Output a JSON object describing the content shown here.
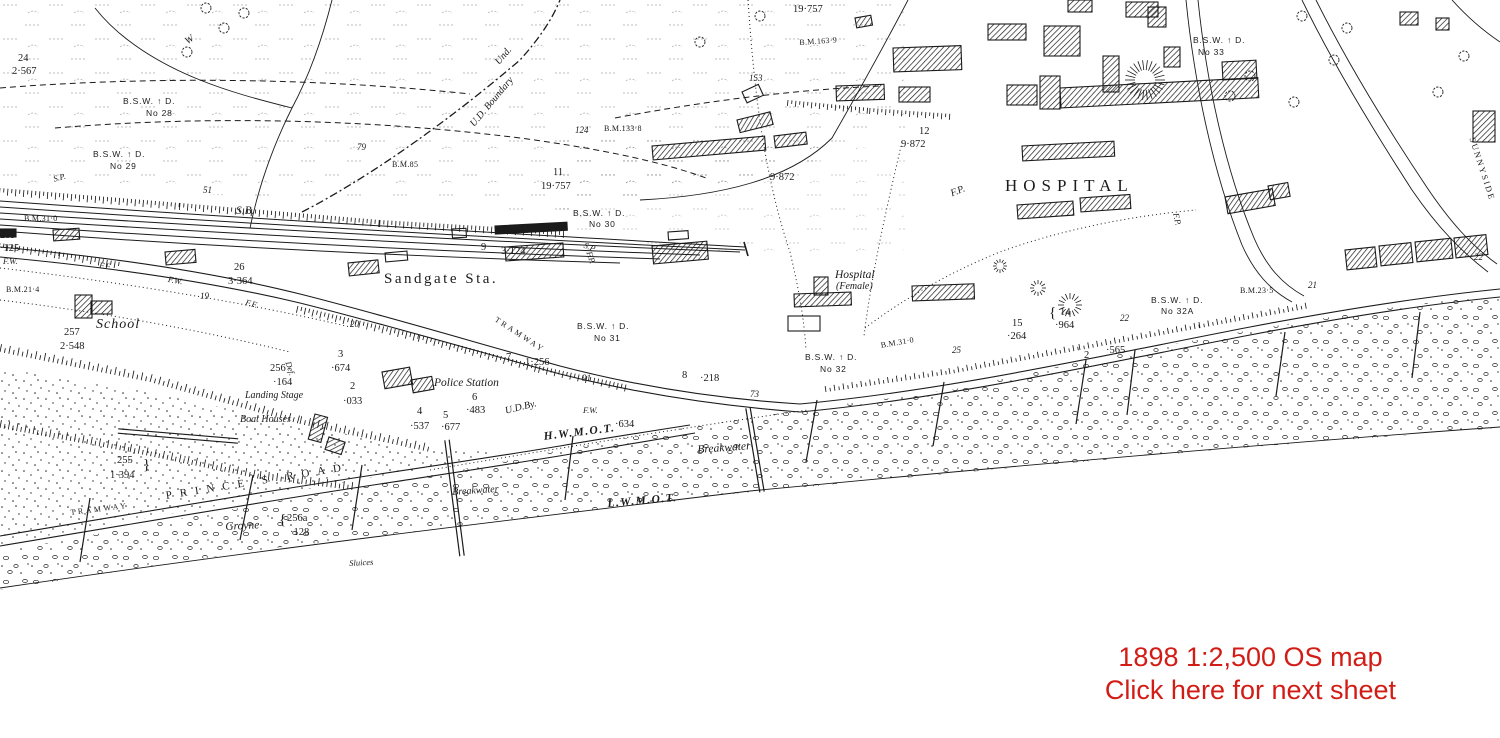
{
  "page": {
    "background": "#ffffff",
    "ink": "#1b1b1b"
  },
  "caption": {
    "line1": "1898 1:2,500 OS map",
    "line2": "Click here for next sheet",
    "color": "#d21c16"
  },
  "map": {
    "labels": [
      {
        "t": "19·757",
        "x": 793,
        "y": 4,
        "s": "n"
      },
      {
        "t": "B.M.163·9",
        "x": 799,
        "y": 38,
        "s": "bm",
        "r": -4
      },
      {
        "t": "153",
        "x": 749,
        "y": 73,
        "s": "it9"
      },
      {
        "t": "124",
        "x": 575,
        "y": 125,
        "s": "it9"
      },
      {
        "t": "B.M.133·8",
        "x": 604,
        "y": 124,
        "s": "bm"
      },
      {
        "t": "11",
        "x": 553,
        "y": 167,
        "s": "n"
      },
      {
        "t": "19·757",
        "x": 541,
        "y": 181,
        "s": "n"
      },
      {
        "t": "B.S.W. ↑ D.",
        "x": 573,
        "y": 208,
        "s": "bsw"
      },
      {
        "t": "No 30",
        "x": 589,
        "y": 219,
        "s": "bsw"
      },
      {
        "t": "Und.",
        "x": 493,
        "y": 60,
        "s": "i",
        "r": -50
      },
      {
        "t": "U.D. Boundary",
        "x": 468,
        "y": 122,
        "s": "i",
        "r": -50
      },
      {
        "t": "24",
        "x": 18,
        "y": 53,
        "s": "n"
      },
      {
        "t": "2·567",
        "x": 12,
        "y": 66,
        "s": "n"
      },
      {
        "t": "B.S.W. ↑ D.",
        "x": 123,
        "y": 96,
        "s": "bsw"
      },
      {
        "t": "No 28",
        "x": 146,
        "y": 108,
        "s": "bsw"
      },
      {
        "t": "B.S.W. ↑ D.",
        "x": 93,
        "y": 149,
        "s": "bsw"
      },
      {
        "t": "No 29",
        "x": 110,
        "y": 161,
        "s": "bsw"
      },
      {
        "t": "W",
        "x": 183,
        "y": 38,
        "s": "i",
        "r": -35
      },
      {
        "t": "79",
        "x": 357,
        "y": 142,
        "s": "it9"
      },
      {
        "t": "B.M.85",
        "x": 392,
        "y": 160,
        "s": "bm"
      },
      {
        "t": "51",
        "x": 203,
        "y": 185,
        "s": "it9"
      },
      {
        "t": "S.P.",
        "x": 52,
        "y": 174,
        "s": "i8",
        "r": -15
      },
      {
        "t": "S.B.",
        "x": 236,
        "y": 205,
        "s": "i11"
      },
      {
        "t": "B.M.31·0",
        "x": 24,
        "y": 214,
        "s": "bm"
      },
      {
        "t": "259",
        "x": 0,
        "y": 230,
        "s": "n"
      },
      {
        "t": "·125",
        "x": 0,
        "y": 243,
        "s": "n"
      },
      {
        "t": "F.W.",
        "x": 3,
        "y": 256,
        "s": "i8"
      },
      {
        "t": "B.M.21·4",
        "x": 6,
        "y": 285,
        "s": "bm"
      },
      {
        "t": "F.F.",
        "x": 100,
        "y": 260,
        "s": "i8",
        "r": 8
      },
      {
        "t": "F.W.",
        "x": 169,
        "y": 274,
        "s": "i8",
        "r": 10
      },
      {
        "t": "F.F.",
        "x": 247,
        "y": 297,
        "s": "i8",
        "r": 15
      },
      {
        "t": "26",
        "x": 234,
        "y": 262,
        "s": "n"
      },
      {
        "t": "3·364",
        "x": 228,
        "y": 276,
        "s": "n"
      },
      {
        "t": "19",
        "x": 200,
        "y": 291,
        "s": "it9"
      },
      {
        "t": "257",
        "x": 64,
        "y": 327,
        "s": "n"
      },
      {
        "t": "School",
        "x": 96,
        "y": 317,
        "s": "sch"
      },
      {
        "t": "2·548",
        "x": 60,
        "y": 341,
        "s": "n"
      },
      {
        "t": "9",
        "x": 481,
        "y": 242,
        "s": "n"
      },
      {
        "t": "3·124",
        "x": 501,
        "y": 246,
        "s": "n"
      },
      {
        "t": "Sandgate Sta.",
        "x": 384,
        "y": 271,
        "s": "sta"
      },
      {
        "t": "S.P.",
        "x": 586,
        "y": 240,
        "s": "i8",
        "r": 20
      },
      {
        "t": "B.S.W. ↑ D.",
        "x": 577,
        "y": 321,
        "s": "bsw"
      },
      {
        "t": "No 31",
        "x": 594,
        "y": 333,
        "s": "bsw"
      },
      {
        "t": "TRAMWAY",
        "x": 498,
        "y": 315,
        "s": "tw",
        "r": 33
      },
      {
        "t": "20",
        "x": 350,
        "y": 319,
        "s": "it9"
      },
      {
        "t": "7",
        "x": 506,
        "y": 352,
        "s": "n"
      },
      {
        "t": "1·256",
        "x": 525,
        "y": 357,
        "s": "n"
      },
      {
        "t": "91",
        "x": 582,
        "y": 373,
        "s": "it9"
      },
      {
        "t": "8",
        "x": 682,
        "y": 370,
        "s": "n"
      },
      {
        "t": "·218",
        "x": 700,
        "y": 373,
        "s": "n"
      },
      {
        "t": "73",
        "x": 750,
        "y": 389,
        "s": "it9"
      },
      {
        "t": "3",
        "x": 338,
        "y": 349,
        "s": "n"
      },
      {
        "t": "·674",
        "x": 331,
        "y": 363,
        "s": "n"
      },
      {
        "t": "256",
        "x": 270,
        "y": 363,
        "s": "n"
      },
      {
        "t": "·164",
        "x": 273,
        "y": 377,
        "s": "n"
      },
      {
        "t": "Def.",
        "x": 293,
        "y": 360,
        "s": "i8",
        "r": 72
      },
      {
        "t": "Landing Stage",
        "x": 245,
        "y": 390,
        "s": "i"
      },
      {
        "t": "Boat Houses",
        "x": 240,
        "y": 414,
        "s": "i"
      },
      {
        "t": "2",
        "x": 350,
        "y": 381,
        "s": "n"
      },
      {
        "t": "·033",
        "x": 343,
        "y": 396,
        "s": "n"
      },
      {
        "t": "Police Station",
        "x": 434,
        "y": 377,
        "s": "i11"
      },
      {
        "t": "6",
        "x": 472,
        "y": 392,
        "s": "n"
      },
      {
        "t": "·483",
        "x": 466,
        "y": 405,
        "s": "n"
      },
      {
        "t": "4",
        "x": 417,
        "y": 406,
        "s": "n"
      },
      {
        "t": "·537",
        "x": 410,
        "y": 421,
        "s": "n"
      },
      {
        "t": "5",
        "x": 443,
        "y": 410,
        "s": "n"
      },
      {
        "t": "·677",
        "x": 441,
        "y": 422,
        "s": "n"
      },
      {
        "t": "U.D.By.",
        "x": 504,
        "y": 406,
        "s": "i",
        "r": -14
      },
      {
        "t": "F.W.",
        "x": 583,
        "y": 405,
        "s": "i8"
      },
      {
        "t": "·634",
        "x": 615,
        "y": 419,
        "s": "n"
      },
      {
        "t": "H.W.M.O.T.",
        "x": 543,
        "y": 431,
        "s": "wm",
        "r": -7
      },
      {
        "t": "Breakwater",
        "x": 697,
        "y": 444,
        "s": "i11",
        "r": -4
      },
      {
        "t": "Breakwater",
        "x": 452,
        "y": 487,
        "s": "i",
        "r": -4
      },
      {
        "t": "L.W.M.O.T.",
        "x": 607,
        "y": 498,
        "s": "wm",
        "r": -5
      },
      {
        "t": "Hospital",
        "x": 835,
        "y": 269,
        "s": "i11"
      },
      {
        "t": "(Female)",
        "x": 836,
        "y": 281,
        "s": "i"
      },
      {
        "t": "B.M.31·0",
        "x": 880,
        "y": 341,
        "s": "bm",
        "r": -10
      },
      {
        "t": "25",
        "x": 952,
        "y": 345,
        "s": "it9"
      },
      {
        "t": "B.S.W. ↑ D.",
        "x": 805,
        "y": 352,
        "s": "bsw"
      },
      {
        "t": "No 32",
        "x": 820,
        "y": 364,
        "s": "bsw"
      },
      {
        "t": "15",
        "x": 1012,
        "y": 318,
        "s": "n"
      },
      {
        "t": "·264",
        "x": 1007,
        "y": 331,
        "s": "n"
      },
      {
        "t": "{",
        "x": 1049,
        "y": 305,
        "s": "brace"
      },
      {
        "t": "14",
        "x": 1060,
        "y": 307,
        "s": "n"
      },
      {
        "t": "·964",
        "x": 1055,
        "y": 320,
        "s": "n"
      },
      {
        "t": "22",
        "x": 1120,
        "y": 313,
        "s": "it9"
      },
      {
        "t": "B.S.W. ↑ D.",
        "x": 1151,
        "y": 295,
        "s": "bsw"
      },
      {
        "t": "No 32A",
        "x": 1161,
        "y": 306,
        "s": "bsw"
      },
      {
        "t": "B.M.23·5",
        "x": 1240,
        "y": 286,
        "s": "bm"
      },
      {
        "t": "21",
        "x": 1308,
        "y": 280,
        "s": "it9"
      },
      {
        "t": "2",
        "x": 1084,
        "y": 350,
        "s": "n"
      },
      {
        "t": "·565",
        "x": 1106,
        "y": 345,
        "s": "n"
      },
      {
        "t": "12",
        "x": 919,
        "y": 126,
        "s": "n"
      },
      {
        "t": "9·872",
        "x": 901,
        "y": 139,
        "s": "n"
      },
      {
        "t": "9·872",
        "x": 770,
        "y": 172,
        "s": "n"
      },
      {
        "t": "HOSPITAL",
        "x": 1005,
        "y": 176,
        "s": "hos"
      },
      {
        "t": "F.P.",
        "x": 949,
        "y": 189,
        "s": "i",
        "r": -22
      },
      {
        "t": "F.P.",
        "x": 594,
        "y": 250,
        "s": "i8",
        "r": 72
      },
      {
        "t": "F.P.",
        "x": 1181,
        "y": 212,
        "s": "i8",
        "r": 78
      },
      {
        "t": "B.S.W. ↑ D.",
        "x": 1193,
        "y": 35,
        "s": "bsw"
      },
      {
        "t": "No 33",
        "x": 1198,
        "y": 47,
        "s": "bsw"
      },
      {
        "t": "SUNNYSIDE",
        "x": 1477,
        "y": 136,
        "s": "sun",
        "r": 72
      },
      {
        "t": "22",
        "x": 1474,
        "y": 252,
        "s": "it9"
      },
      {
        "t": "255",
        "x": 117,
        "y": 455,
        "s": "n"
      },
      {
        "t": "1·394",
        "x": 110,
        "y": 470,
        "s": "n"
      },
      {
        "t": "}",
        "x": 143,
        "y": 457,
        "s": "brace"
      },
      {
        "t": "TRAMWAY",
        "x": 70,
        "y": 508,
        "s": "tw",
        "r": -7
      },
      {
        "t": "PRINCE'S ROAD",
        "x": 165,
        "y": 490,
        "s": "rd",
        "r": -9
      },
      {
        "t": "Groyne",
        "x": 225,
        "y": 521,
        "s": "i11",
        "r": -3
      },
      {
        "t": "{",
        "x": 279,
        "y": 512,
        "s": "brace"
      },
      {
        "t": "256a",
        "x": 287,
        "y": 513,
        "s": "n"
      },
      {
        "t": "·128",
        "x": 290,
        "y": 527,
        "s": "n"
      },
      {
        "t": "Sluices",
        "x": 349,
        "y": 558,
        "s": "i8",
        "r": -3
      }
    ],
    "buildings": [
      {
        "x": 348,
        "y": 263,
        "w": 30,
        "h": 13,
        "r": -6,
        "f": "h"
      },
      {
        "x": 385,
        "y": 253,
        "w": 22,
        "h": 9,
        "r": -5,
        "f": "o"
      },
      {
        "x": 495,
        "y": 226,
        "w": 72,
        "h": 8,
        "r": -3,
        "f": "s"
      },
      {
        "x": 505,
        "y": 247,
        "w": 58,
        "h": 14,
        "r": -4,
        "f": "h"
      },
      {
        "x": 652,
        "y": 246,
        "w": 55,
        "h": 18,
        "r": -5,
        "f": "h"
      },
      {
        "x": 668,
        "y": 232,
        "w": 20,
        "h": 8,
        "r": -4,
        "f": "o"
      },
      {
        "x": 452,
        "y": 229,
        "w": 14,
        "h": 9,
        "r": -3,
        "f": "o"
      },
      {
        "x": 75,
        "y": 295,
        "w": 17,
        "h": 23,
        "r": 0,
        "f": "h"
      },
      {
        "x": 91,
        "y": 301,
        "w": 21,
        "h": 13,
        "r": 0,
        "f": "h"
      },
      {
        "x": 53,
        "y": 230,
        "w": 26,
        "h": 11,
        "r": -4,
        "f": "h"
      },
      {
        "x": 0,
        "y": 229,
        "w": 16,
        "h": 8,
        "r": 0,
        "f": "s"
      },
      {
        "x": 165,
        "y": 252,
        "w": 30,
        "h": 13,
        "r": -5,
        "f": "h"
      },
      {
        "x": 382,
        "y": 372,
        "w": 28,
        "h": 17,
        "r": -10,
        "f": "h"
      },
      {
        "x": 411,
        "y": 380,
        "w": 21,
        "h": 13,
        "r": -10,
        "f": "h"
      },
      {
        "x": 315,
        "y": 414,
        "w": 13,
        "h": 26,
        "r": 15,
        "f": "h"
      },
      {
        "x": 329,
        "y": 437,
        "w": 17,
        "h": 13,
        "r": 18,
        "f": "h"
      },
      {
        "x": 794,
        "y": 294,
        "w": 57,
        "h": 13,
        "r": -2,
        "f": "h"
      },
      {
        "x": 814,
        "y": 277,
        "w": 14,
        "h": 18,
        "r": 0,
        "f": "h"
      },
      {
        "x": 912,
        "y": 286,
        "w": 62,
        "h": 15,
        "r": -2,
        "f": "h"
      },
      {
        "x": 788,
        "y": 316,
        "w": 32,
        "h": 15,
        "r": 0,
        "f": "o"
      },
      {
        "x": 893,
        "y": 48,
        "w": 68,
        "h": 24,
        "r": -2,
        "f": "h"
      },
      {
        "x": 988,
        "y": 24,
        "w": 38,
        "h": 16,
        "r": 0,
        "f": "h"
      },
      {
        "x": 1044,
        "y": 26,
        "w": 36,
        "h": 30,
        "r": 0,
        "f": "h"
      },
      {
        "x": 1068,
        "y": 0,
        "w": 24,
        "h": 12,
        "r": 0,
        "f": "h"
      },
      {
        "x": 1126,
        "y": 2,
        "w": 32,
        "h": 15,
        "r": 0,
        "f": "h"
      },
      {
        "x": 836,
        "y": 86,
        "w": 48,
        "h": 15,
        "r": -2,
        "f": "h"
      },
      {
        "x": 899,
        "y": 87,
        "w": 31,
        "h": 15,
        "r": 0,
        "f": "h"
      },
      {
        "x": 1060,
        "y": 88,
        "w": 198,
        "h": 20,
        "r": -3,
        "f": "h"
      },
      {
        "x": 1103,
        "y": 56,
        "w": 16,
        "h": 36,
        "r": 0,
        "f": "h"
      },
      {
        "x": 1222,
        "y": 62,
        "w": 34,
        "h": 18,
        "r": -3,
        "f": "h"
      },
      {
        "x": 1007,
        "y": 85,
        "w": 30,
        "h": 20,
        "r": 0,
        "f": "h"
      },
      {
        "x": 1022,
        "y": 146,
        "w": 92,
        "h": 15,
        "r": -3,
        "f": "h"
      },
      {
        "x": 652,
        "y": 146,
        "w": 113,
        "h": 14,
        "r": -5,
        "f": "h"
      },
      {
        "x": 737,
        "y": 120,
        "w": 34,
        "h": 13,
        "r": -14,
        "f": "h"
      },
      {
        "x": 774,
        "y": 136,
        "w": 32,
        "h": 12,
        "r": -7,
        "f": "h"
      },
      {
        "x": 742,
        "y": 92,
        "w": 18,
        "h": 12,
        "r": -25,
        "f": "o"
      },
      {
        "x": 855,
        "y": 18,
        "w": 16,
        "h": 10,
        "r": -10,
        "f": "h"
      },
      {
        "x": 1040,
        "y": 76,
        "w": 20,
        "h": 33,
        "r": 0,
        "f": "h"
      },
      {
        "x": 1148,
        "y": 7,
        "w": 18,
        "h": 20,
        "r": 0,
        "f": "h"
      },
      {
        "x": 1164,
        "y": 47,
        "w": 16,
        "h": 20,
        "r": 0,
        "f": "h"
      },
      {
        "x": 1225,
        "y": 197,
        "w": 48,
        "h": 17,
        "r": -10,
        "f": "h"
      },
      {
        "x": 1268,
        "y": 186,
        "w": 20,
        "h": 14,
        "r": -10,
        "f": "h"
      },
      {
        "x": 1400,
        "y": 12,
        "w": 18,
        "h": 13,
        "r": 0,
        "f": "h"
      },
      {
        "x": 1436,
        "y": 18,
        "w": 13,
        "h": 12,
        "r": 0,
        "f": "h"
      },
      {
        "x": 1473,
        "y": 111,
        "w": 22,
        "h": 31,
        "r": 0,
        "f": "h"
      },
      {
        "x": 1017,
        "y": 205,
        "w": 56,
        "h": 14,
        "r": -4,
        "f": "h"
      },
      {
        "x": 1080,
        "y": 198,
        "w": 50,
        "h": 14,
        "r": -4,
        "f": "h"
      },
      {
        "x": 1345,
        "y": 250,
        "w": 30,
        "h": 20,
        "r": -6,
        "f": "h"
      },
      {
        "x": 1379,
        "y": 246,
        "w": 32,
        "h": 20,
        "r": -6,
        "f": "h"
      },
      {
        "x": 1415,
        "y": 242,
        "w": 36,
        "h": 20,
        "r": -6,
        "f": "h"
      },
      {
        "x": 1454,
        "y": 238,
        "w": 32,
        "h": 20,
        "r": -6,
        "f": "h"
      }
    ],
    "groynes": [
      {
        "x1": 90,
        "y1": 498,
        "x2": 80,
        "y2": 562,
        "d": false
      },
      {
        "x1": 253,
        "y1": 475,
        "x2": 240,
        "y2": 540,
        "d": false
      },
      {
        "x1": 362,
        "y1": 465,
        "x2": 352,
        "y2": 530,
        "d": false
      },
      {
        "x1": 447,
        "y1": 440,
        "x2": 462,
        "y2": 556,
        "d": true
      },
      {
        "x1": 573,
        "y1": 436,
        "x2": 565,
        "y2": 500,
        "d": false
      },
      {
        "x1": 748,
        "y1": 408,
        "x2": 762,
        "y2": 492,
        "d": true
      },
      {
        "x1": 817,
        "y1": 400,
        "x2": 806,
        "y2": 462,
        "d": false
      },
      {
        "x1": 944,
        "y1": 382,
        "x2": 933,
        "y2": 446,
        "d": false
      },
      {
        "x1": 1086,
        "y1": 360,
        "x2": 1076,
        "y2": 424,
        "d": false
      },
      {
        "x1": 1135,
        "y1": 350,
        "x2": 1127,
        "y2": 415,
        "d": false
      },
      {
        "x1": 1285,
        "y1": 332,
        "x2": 1276,
        "y2": 396,
        "d": false
      },
      {
        "x1": 1420,
        "y1": 312,
        "x2": 1412,
        "y2": 378,
        "d": false
      },
      {
        "x1": 118,
        "y1": 431,
        "x2": 238,
        "y2": 441,
        "d": true
      }
    ]
  }
}
